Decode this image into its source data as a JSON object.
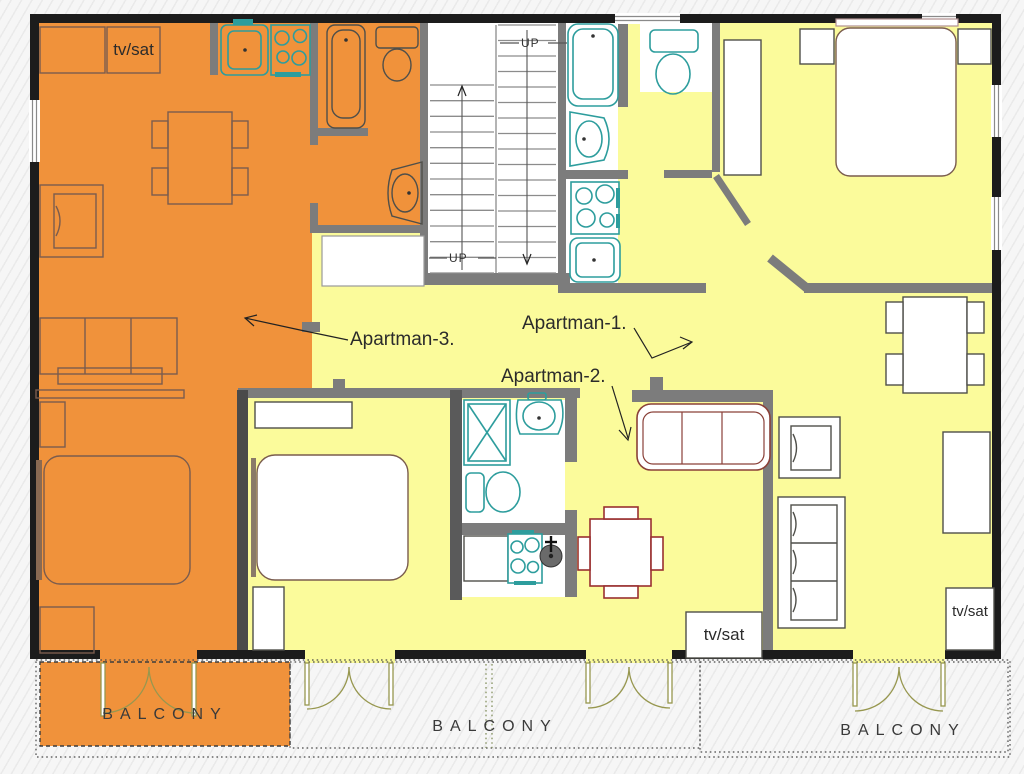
{
  "title": "Apartment floor plan with three apartments and balconies",
  "labels": {
    "apartman_1": "Apartman-1.",
    "apartman_2": "Apartman-2.",
    "apartman_3": "Apartman-3.",
    "tv_sat_top_left": "tv/sat",
    "tv_sat_middle": "tv/sat",
    "tv_sat_bottom_right": "tv/sat",
    "balcony_left": "BALCONY",
    "balcony_middle": "BALCONY",
    "balcony_right": "BALCONY",
    "up_upper": "UP",
    "up_lower": "UP"
  },
  "colors": {
    "apartment3_fill": "#F0923B",
    "shared_fill": "#FBFB9B",
    "exterior_wall": "#1C1C1C",
    "interior_wall": "#7C7C7C",
    "fixture_teal": "#2D9D9D",
    "furniture_brown": "#7A5C4E",
    "accent_red": "#993030",
    "door_olive": "#97974F"
  }
}
